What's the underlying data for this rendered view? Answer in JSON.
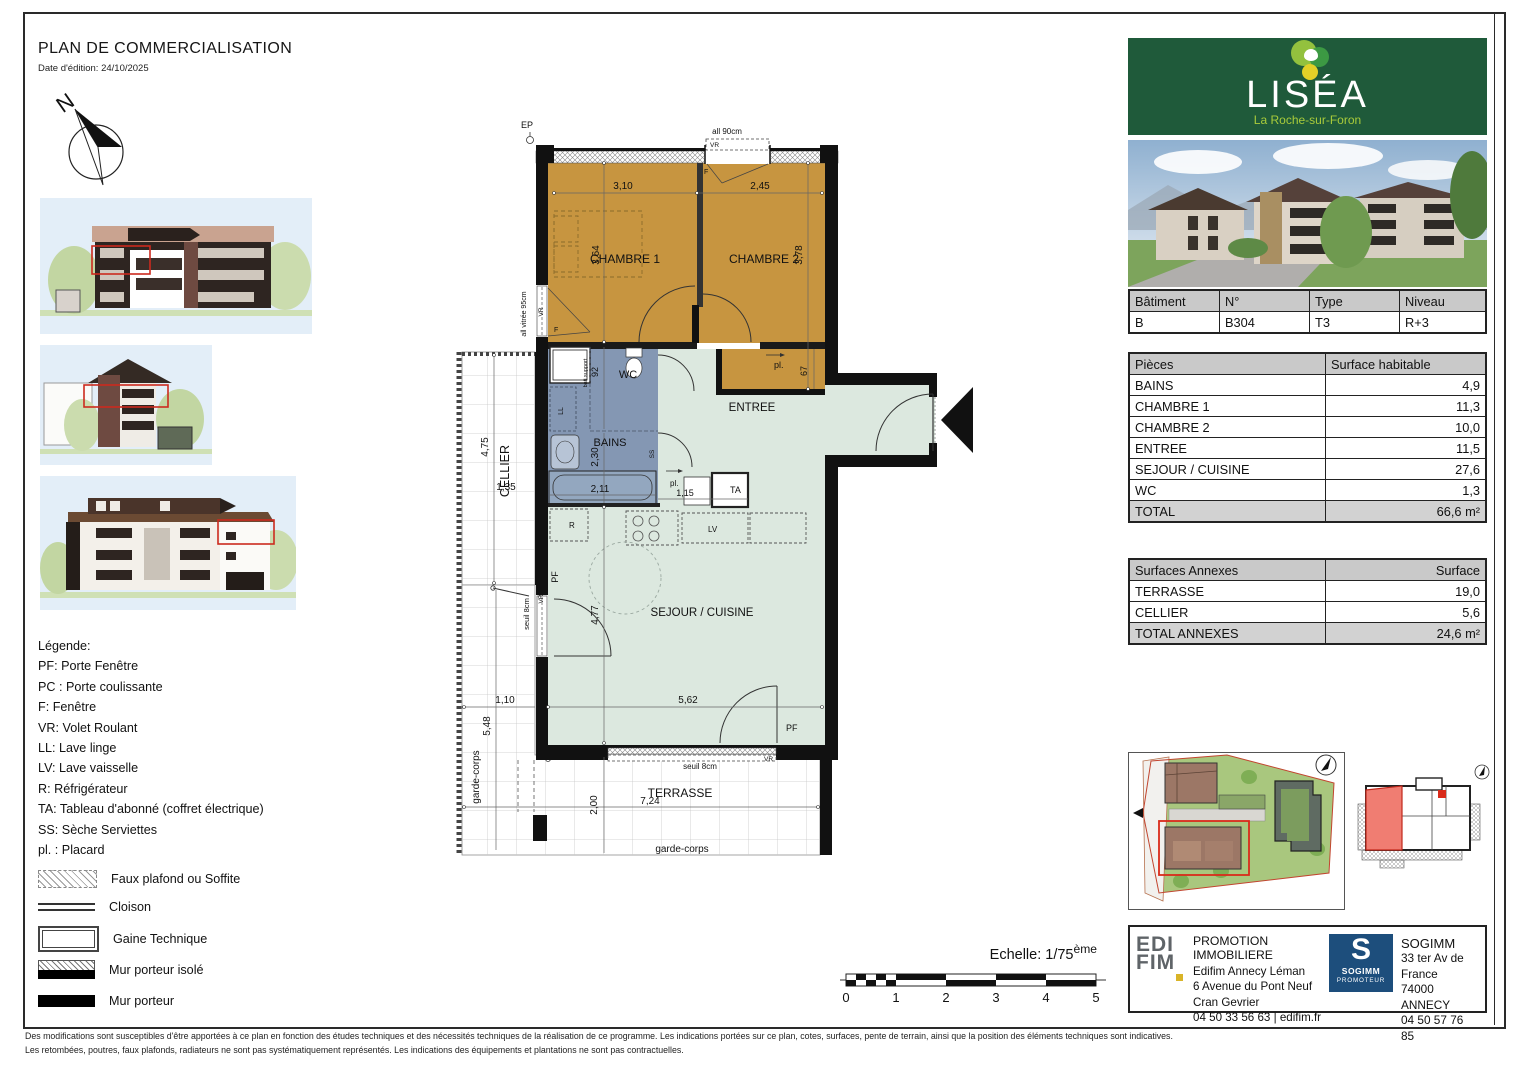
{
  "header": {
    "title": "PLAN DE COMMERCIALISATION",
    "date": "Date d'édition: 24/10/2025"
  },
  "compass": {
    "north": "N"
  },
  "legend": {
    "title": "Légende:",
    "items": [
      "PF: Porte Fenêtre",
      "PC : Porte coulissante",
      "F: Fenêtre",
      "VR: Volet Roulant",
      "LL: Lave linge",
      "LV: Lave vaisselle",
      "R: Réfrigérateur",
      "TA: Tableau d'abonné (coffret électrique)",
      "SS: Sèche Serviettes",
      "pl. : Placard"
    ],
    "symbols": [
      {
        "label": "Faux plafond ou Soffite"
      },
      {
        "label": "Cloison"
      },
      {
        "label": "Gaine Technique"
      },
      {
        "label": "Mur porteur isolé"
      },
      {
        "label": "Mur porteur"
      }
    ]
  },
  "plan": {
    "ep": "EP",
    "win_top": "all 90cm",
    "win_left": "all vitrée 95cm",
    "vr": "VR",
    "f": "F",
    "pf": "PF",
    "ll": "LL",
    "lv": "LV",
    "ss": "SS",
    "r": "R",
    "ta": "TA",
    "pl": "pl.",
    "seuil": "seuil 8cm",
    "garde_corps": "garde-corps",
    "bati_support": "bati support",
    "rooms": {
      "chambre1": "CHAMBRE 1",
      "chambre2": "CHAMBRE 2",
      "wc": "WC",
      "bains": "BAINS",
      "entree": "ENTREE",
      "sejour": "SEJOUR / CUISINE",
      "cellier": "CELLIER",
      "terrasse": "TERRASSE"
    },
    "dims": {
      "c1_w": "3,10",
      "c1_h": "3,64",
      "c2_w": "2,45",
      "c2_h": "3,78",
      "pl67": "67",
      "wc92": "92",
      "bains_h": "2,30",
      "bains_w": "2,11",
      "pl115": "1,15",
      "sejour_h": "4,77",
      "sejour_w": "5,62",
      "cellier_h": "4,75",
      "cellier_w": "1,35",
      "terrasse_h": "2,00",
      "terrasse_w": "7,24",
      "balcon_w": "1,10",
      "balcon_h": "5,48"
    },
    "colors": {
      "chambre": "#c79540",
      "sanitaire": "#8497b3",
      "sejour": "#dce8df"
    }
  },
  "scale": {
    "label": "Echelle: 1/75",
    "sup": "ème",
    "ticks": [
      "0",
      "1",
      "2",
      "3",
      "4",
      "5"
    ]
  },
  "branding": {
    "name": "LISÉA",
    "city": "La Roche-sur-Foron",
    "green": "#1f5a3a"
  },
  "unit_table": {
    "headers": [
      "Bâtiment",
      "N°",
      "Type",
      "Niveau"
    ],
    "values": [
      "B",
      "B304",
      "T3",
      "R+3"
    ]
  },
  "surface_table": {
    "headers": [
      "Pièces",
      "Surface habitable"
    ],
    "rows": [
      [
        "BAINS",
        "4,9"
      ],
      [
        "CHAMBRE 1",
        "11,3"
      ],
      [
        "CHAMBRE 2",
        "10,0"
      ],
      [
        "ENTREE",
        "11,5"
      ],
      [
        "SEJOUR / CUISINE",
        "27,6"
      ],
      [
        "WC",
        "1,3"
      ]
    ],
    "total": [
      "TOTAL",
      "66,6 m²"
    ]
  },
  "annex_table": {
    "headers": [
      "Surfaces Annexes",
      "Surface"
    ],
    "rows": [
      [
        "TERRASSE",
        "19,0"
      ],
      [
        "CELLIER",
        "5,6"
      ]
    ],
    "total": [
      "TOTAL ANNEXES",
      "24,6 m²"
    ]
  },
  "promoters": {
    "edifim": {
      "logo_top": "EDI",
      "logo_bottom": "FIM",
      "title": "PROMOTION IMMOBILIERE",
      "lines": [
        "Edifim Annecy Léman",
        "6 Avenue du Pont Neuf",
        "Cran Gevrier",
        "04 50 33 56 63 | edifim.fr"
      ]
    },
    "sogimm": {
      "letter": "S",
      "word": "SOGIMM",
      "sub": "PROMOTEUR",
      "name": "SOGIMM",
      "lines": [
        "33 ter Av de France",
        "74000 ANNECY",
        "04 50 57 76 85"
      ]
    }
  },
  "footer": {
    "line1": "Des modifications sont susceptibles d'être apportées à ce plan en fonction des études techniques et des nécessités techniques de la réalisation de ce programme. Les indications portées sur ce plan, cotes, surfaces, pente de terrain, ainsi que la position des éléments techniques sont indicatives.",
    "line2": "Les retombées, poutres, faux plafonds, radiateurs ne sont pas systématiquement représentés. Les indications des équipements et plantations ne sont pas contractuelles."
  }
}
